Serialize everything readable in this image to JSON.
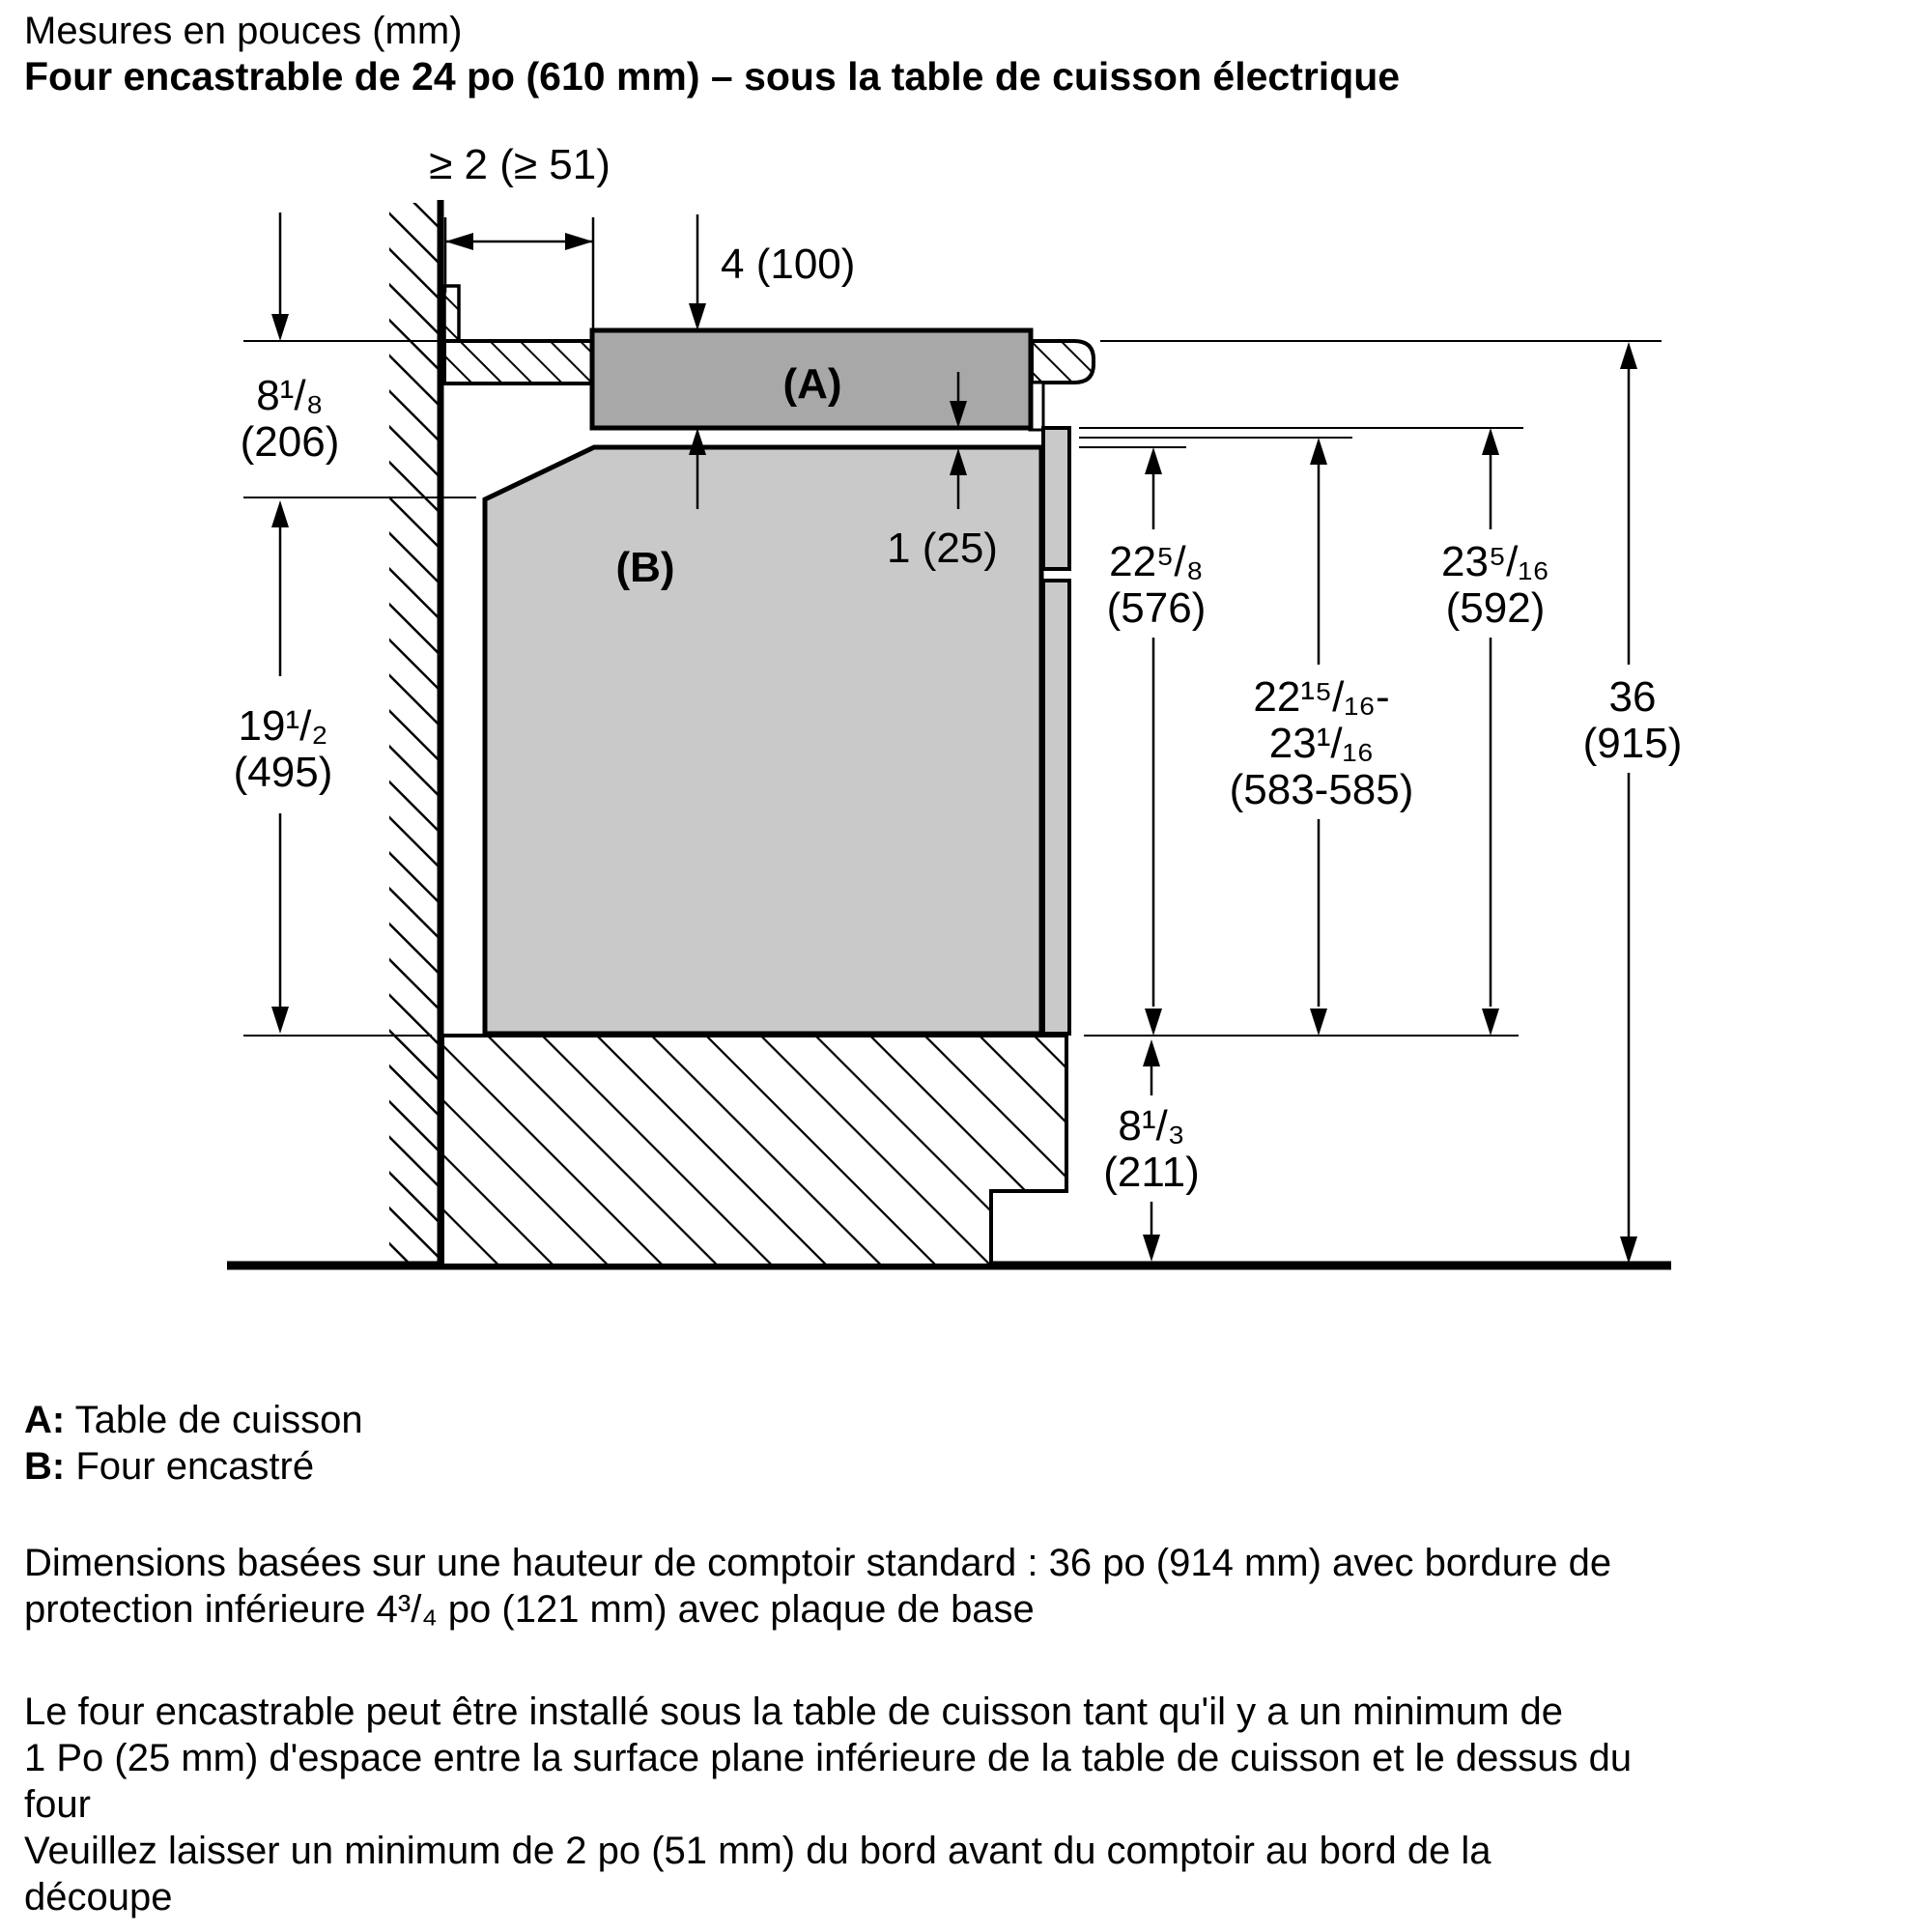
{
  "title": {
    "line1": "Mesures en pouces (mm)",
    "line2": "Four encastrable de 24 po (610 mm) – sous la table de cuisson électrique"
  },
  "diagram": {
    "labels": {
      "cooktop": "(A)",
      "oven": "(B)"
    },
    "dimensions": {
      "wall_clearance": "≥ 2 (≥ 51)",
      "cooktop_thickness": "4 (100)",
      "air_gap": "1 (25)",
      "countertop_to_oven_top": {
        "inches": "8¹/₈",
        "mm": "(206)"
      },
      "oven_height": {
        "inches": "19¹/₂",
        "mm": "(495)"
      },
      "niche_from_oven_top": {
        "inches": "22⁵/₈",
        "mm": "(576)"
      },
      "niche_from_counter_bottom": {
        "inches": "23⁵/₁₆",
        "mm": "(592)"
      },
      "cutout_range": {
        "line1": "22¹⁵/₁₆-",
        "line2": "23¹/₁₆",
        "line3": "(583-585)"
      },
      "counter_height": {
        "inches": "36",
        "mm": "(915)"
      },
      "base_height": {
        "inches": "8¹/₃",
        "mm": "(211)"
      }
    }
  },
  "legend": [
    {
      "key": "A:",
      "label": " Table de cuisson"
    },
    {
      "key": "B:",
      "label": " Four encastré"
    }
  ],
  "paragraphs": [
    {
      "lines": [
        "Dimensions basées sur une hauteur de comptoir standard : 36 po (914 mm) avec bordure de",
        "protection inférieure 4³/₄ po (121 mm) avec plaque de base"
      ]
    },
    {
      "lines": [
        "Le four encastrable peut être installé sous la table de cuisson tant qu'il y a un minimum de",
        "1 Po (25 mm) d'espace entre la surface plane inférieure de la table de cuisson et le dessus du",
        "four"
      ]
    },
    {
      "lines": [
        "Veuillez laisser un minimum de 2 po (51 mm) du bord avant du comptoir au bord de la",
        "découpe"
      ]
    }
  ]
}
